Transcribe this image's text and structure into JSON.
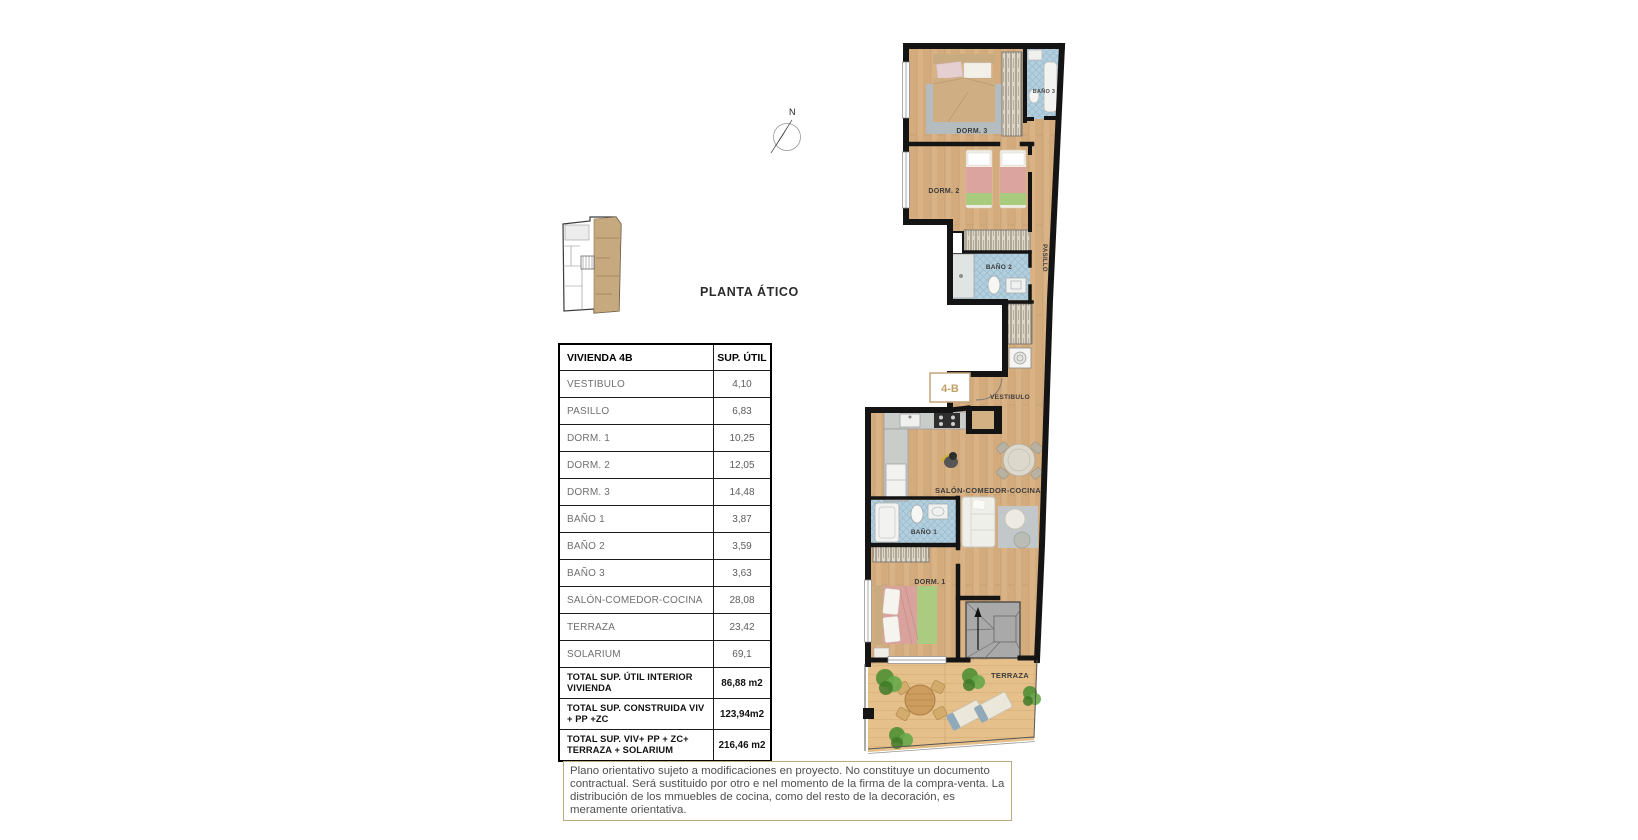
{
  "page": {
    "plan_title": "PLANTA ÁTICO"
  },
  "compass": {
    "north_label": "N"
  },
  "area_table": {
    "header": {
      "unit": "VIVIENDA 4B",
      "column": "SUP. ÚTIL"
    },
    "rows": [
      {
        "label": "VESTIBULO",
        "value": "4,10"
      },
      {
        "label": "PASILLO",
        "value": "6,83"
      },
      {
        "label": "DORM. 1",
        "value": "10,25"
      },
      {
        "label": "DORM. 2",
        "value": "12,05"
      },
      {
        "label": "DORM. 3",
        "value": "14,48"
      },
      {
        "label": "BAÑO 1",
        "value": "3,87"
      },
      {
        "label": "BAÑO 2",
        "value": "3,59"
      },
      {
        "label": "BAÑO 3",
        "value": "3,63"
      },
      {
        "label": "SALÓN-COMEDOR-COCINA",
        "value": "28,08"
      },
      {
        "label": "TERRAZA",
        "value": "23,42"
      },
      {
        "label": "SOLARIUM",
        "value": "69,1"
      }
    ],
    "totals": [
      {
        "label": "TOTAL SUP. ÚTIL INTERIOR VIVIENDA",
        "value": "86,88 m2"
      },
      {
        "label": "TOTAL SUP. CONSTRUIDA VIV + PP +ZC",
        "value": "123,94m2"
      },
      {
        "label": "TOTAL SUP. VIV+ PP + ZC+ TERRAZA + SOLARIUM",
        "value": "216,46 m2"
      }
    ]
  },
  "floor_plan": {
    "unit_badge": "4-B",
    "labels": {
      "dorm3": "DORM. 3",
      "bano3": "BAÑO 3",
      "dorm2": "DORM. 2",
      "bano2": "BAÑO 2",
      "pasillo": "PASILLO",
      "vestibulo": "VESTIBULO",
      "salon": "SALÓN-COMEDOR-COCINA",
      "bano1": "BAÑO 1",
      "dorm1": "DORM. 1",
      "terraza": "TERRAZA"
    }
  },
  "disclaimer": {
    "text": "Plano orientativo sujeto a modificaciones en proyecto. No constituye un documento contractual. Será sustituido por otro e nel momento de la firma de la compra-venta. La distribución de los mmuebles de cocina, como del resto de la decoración, es meramente orientativa."
  },
  "colors": {
    "wall": "#141414",
    "wood_floor": "#d9b285",
    "deck_floor": "#e5c08a",
    "bath_tile": "#b3cedd",
    "accent_tan": "#bfa065",
    "disclaimer_border": "#bcab7e"
  }
}
